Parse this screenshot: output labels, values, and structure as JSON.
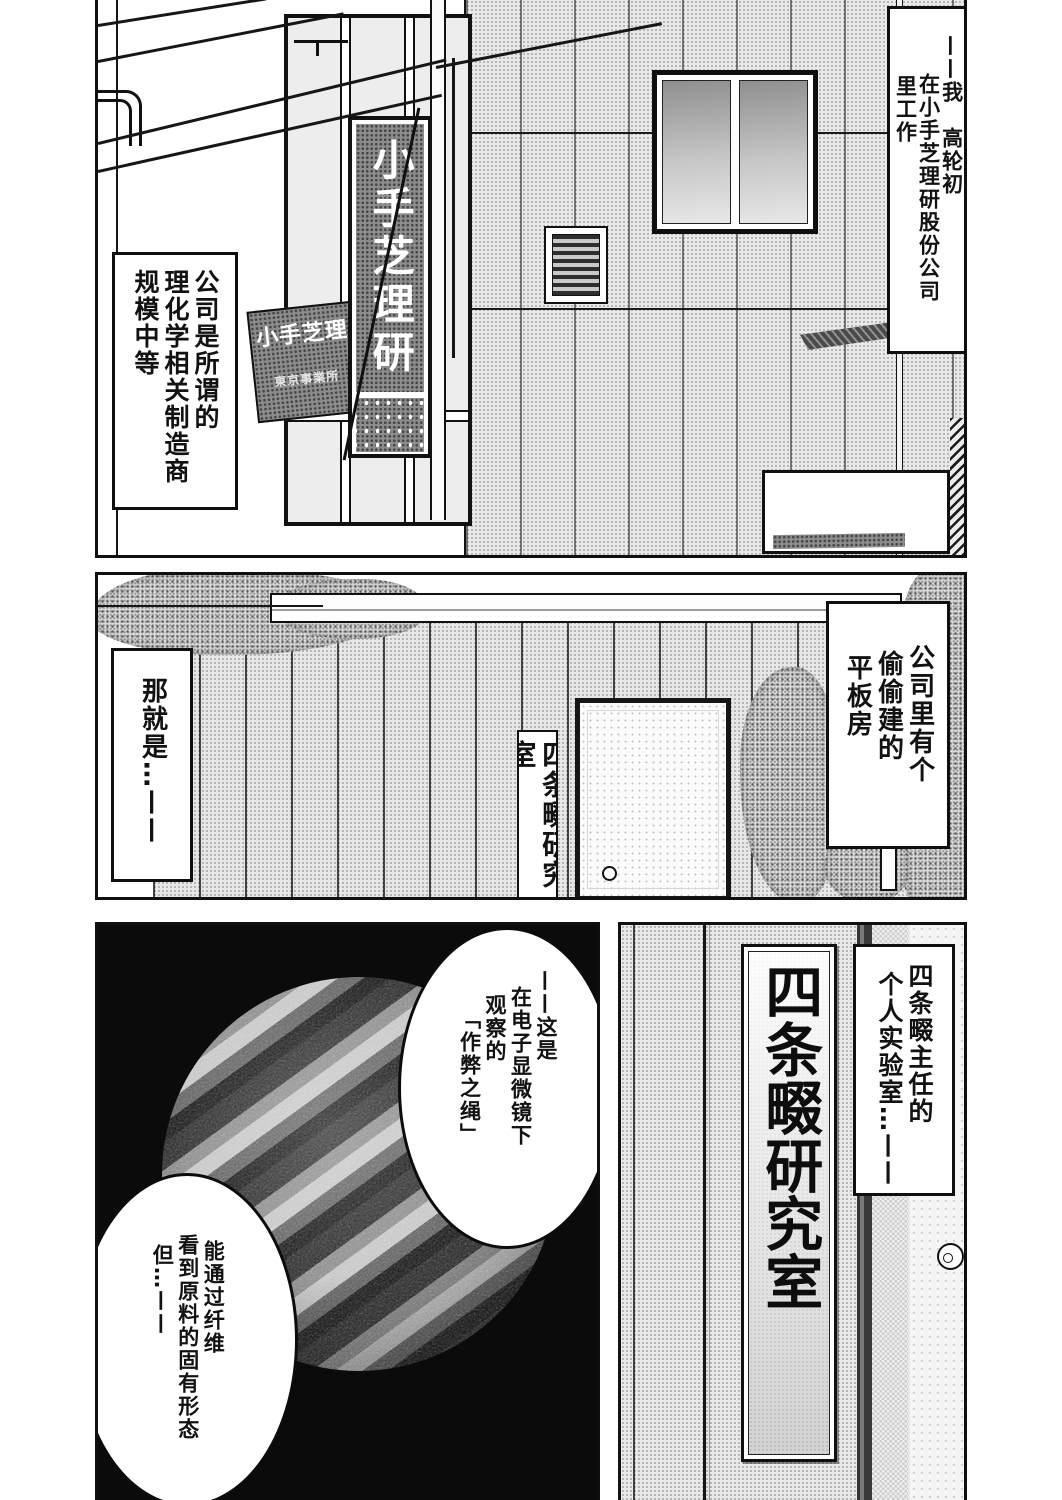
{
  "colors": {
    "paper": "#ffffff",
    "ink": "#111111",
    "panel3_background": "#0b0b0b",
    "tone_light": "#e9e9e9",
    "tone_dark": "#8d8d8d"
  },
  "panel1": {
    "caption_right": {
      "lines": [
        "——我　高轮初",
        "在小手芝理研股份公司",
        "里工作"
      ]
    },
    "caption_left": {
      "lines": [
        "公司是所谓的",
        "理化学相关制造商",
        "规模中等"
      ]
    },
    "sign_main": {
      "text": "小手芝理研"
    },
    "sign_small": {
      "line1": "小手芝理",
      "line2": "東京事業所"
    }
  },
  "panel2": {
    "caption_right": {
      "lines": [
        "公司里有个",
        "偷偷建的",
        "平板房"
      ]
    },
    "caption_left": {
      "lines": [
        "那就是…——"
      ]
    },
    "door_sign": {
      "text": "四条畷研究室"
    }
  },
  "panel3": {
    "bubble_top": {
      "lines": [
        "——这是",
        "在电子显微镜下",
        "观察的",
        "「作弊之绳」"
      ]
    },
    "bubble_bottom": {
      "lines": [
        "能通过纤维",
        "看到原料的固有形态",
        "但…——"
      ]
    }
  },
  "panel4": {
    "plaque": {
      "text": "四条畷研究室"
    },
    "caption": {
      "lines": [
        "四条畷主任的",
        "个人实验室…——"
      ]
    }
  }
}
